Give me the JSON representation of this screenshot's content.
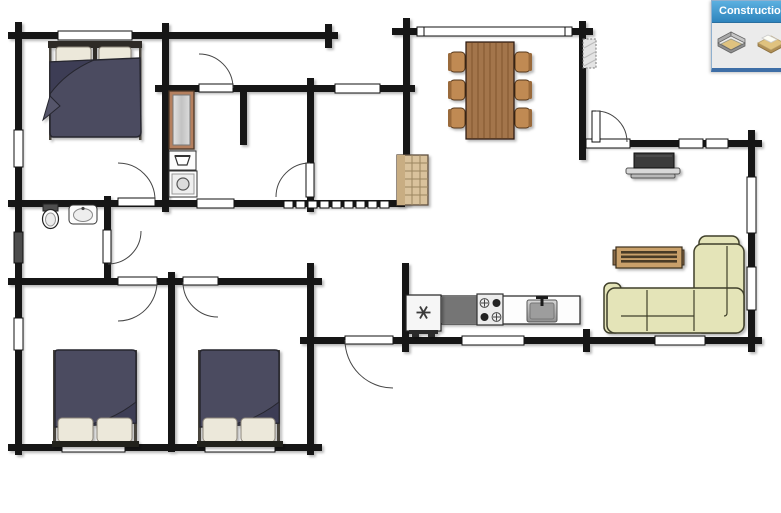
{
  "panel": {
    "title": "Construction",
    "tools": [
      {
        "name": "build-walls-tool",
        "icon": "walls-3d-icon"
      },
      {
        "name": "flooring-tool",
        "icon": "floor-tile-icon"
      }
    ]
  },
  "colors": {
    "wall": "#151515",
    "duvet": "#4b4b61",
    "pillow": "#ece8da",
    "wood": "#a3744c",
    "chair": "#c08a52",
    "sofa": "#e4e4b8",
    "counter_dark": "#757575",
    "fireplace": "#d9c29c",
    "closet_frame": "#b5805f",
    "tv": "#3a3a3a",
    "panel_header": "#5cb0e0",
    "panel_header_dark": "#2e84bd",
    "panel_body": "#ebebeb",
    "panel_border": "#8fb0cf",
    "panel_bottom": "#3e6ea6"
  },
  "floorplan": {
    "furniture": [
      {
        "name": "master-double-bed"
      },
      {
        "name": "wardrobe-closet"
      },
      {
        "name": "laundry-sink"
      },
      {
        "name": "washing-machine"
      },
      {
        "name": "toilet"
      },
      {
        "name": "bathroom-sink"
      },
      {
        "name": "double-bed-1"
      },
      {
        "name": "double-bed-2"
      },
      {
        "name": "dining-table"
      },
      {
        "name": "dining-chair",
        "count": 6
      },
      {
        "name": "masonry-fireplace"
      },
      {
        "name": "chimney"
      },
      {
        "name": "tv-on-stand"
      },
      {
        "name": "coffee-table"
      },
      {
        "name": "corner-sofa"
      },
      {
        "name": "refrigerator"
      },
      {
        "name": "cooktop"
      },
      {
        "name": "kitchen-sink"
      }
    ]
  }
}
